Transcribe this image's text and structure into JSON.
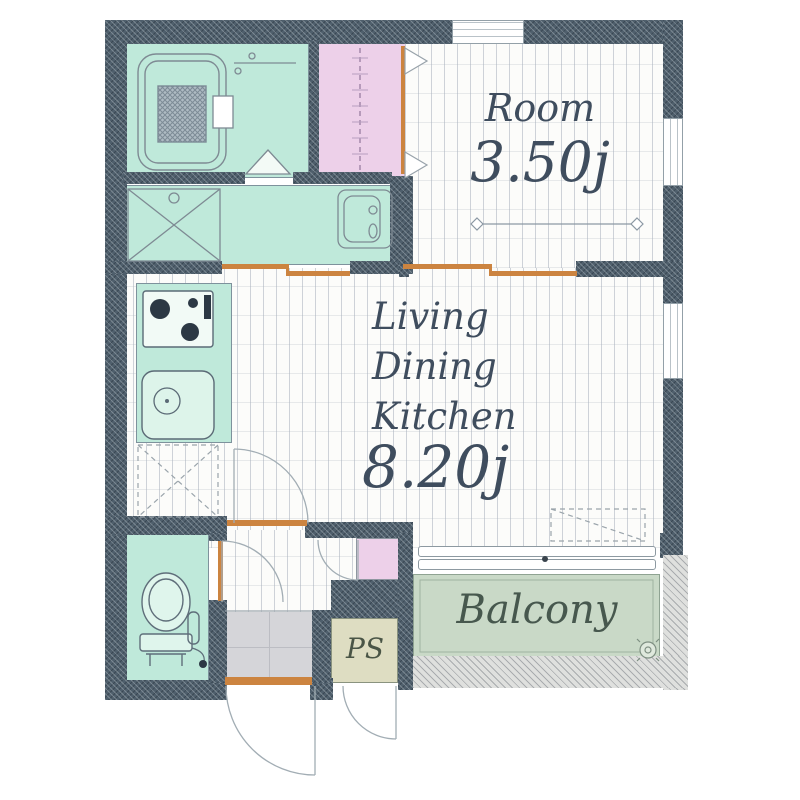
{
  "floorplan": {
    "type": "apartment-floor-plan",
    "rooms": {
      "bedroom": {
        "name": "Room",
        "area": "3.50j"
      },
      "ldk": {
        "lines": [
          "Living",
          "Dining",
          "Kitchen"
        ],
        "area": "8.20j"
      },
      "balcony": {
        "name": "Balcony"
      },
      "pipe_space": {
        "name": "PS"
      }
    },
    "fixtures": [
      "bathtub",
      "bathroom-folding-door",
      "closet-hanger-rod",
      "washing-machine-pan",
      "washbasin",
      "kitchen-stove",
      "kitchen-sink",
      "refrigerator-space",
      "air-conditioner-space",
      "toilet",
      "shoe-cabinet",
      "entrance-door",
      "pipe-space-door",
      "balcony-sliding-window",
      "balcony-drain",
      "dimension-line"
    ],
    "colors": {
      "wall": "#4f5f6c",
      "wet_area": "#bfe9da",
      "closet": "#edd0e9",
      "balcony": "#c9d9c7",
      "pipe_space": "#deddc2",
      "entrance_tile": "#d5d5d9",
      "door_frame": "#cc8440",
      "label_text": "#3f4d5e",
      "floor": "#fcfcfa"
    }
  }
}
